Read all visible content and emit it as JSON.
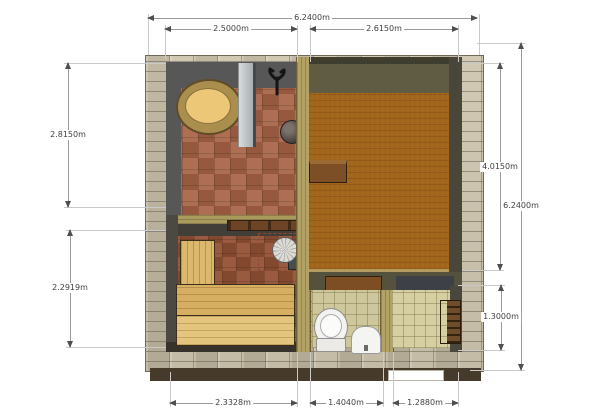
{
  "drawing": {
    "type": "bathhouse-floor-plan",
    "unit": "m"
  },
  "dimensions": {
    "top_total": "6.2400m",
    "top_left_span": "2.5000m",
    "top_right_span": "2.6150m",
    "left_upper": "2.8150m",
    "left_lower": "2.2919m",
    "right_inner": "4.0150m",
    "right_total": "6.2400m",
    "right_lower": "1.3000m",
    "bottom_left": "2.3328m",
    "bottom_center": "1.4040m",
    "bottom_right": "1.2880m"
  },
  "icons": {
    "wall_hooks": "wall-hooks-icon",
    "sauna_heater": "sauna-heater-icon",
    "bucket": "bucket-icon"
  },
  "colors": {
    "stone_wall": "#c6bda7",
    "interior_wall_dark": "#575757",
    "wood_partition": "#b3a266",
    "washroom_tile": "#a5654a",
    "restroom_carpet": "#a4671e",
    "sauna_bench_wood": "#dcb76e",
    "wc_tile": "#cfc79c",
    "plinth": "#463a2b",
    "dimension_line": "#9a9a9a",
    "dimension_text": "#3f3f3f"
  }
}
